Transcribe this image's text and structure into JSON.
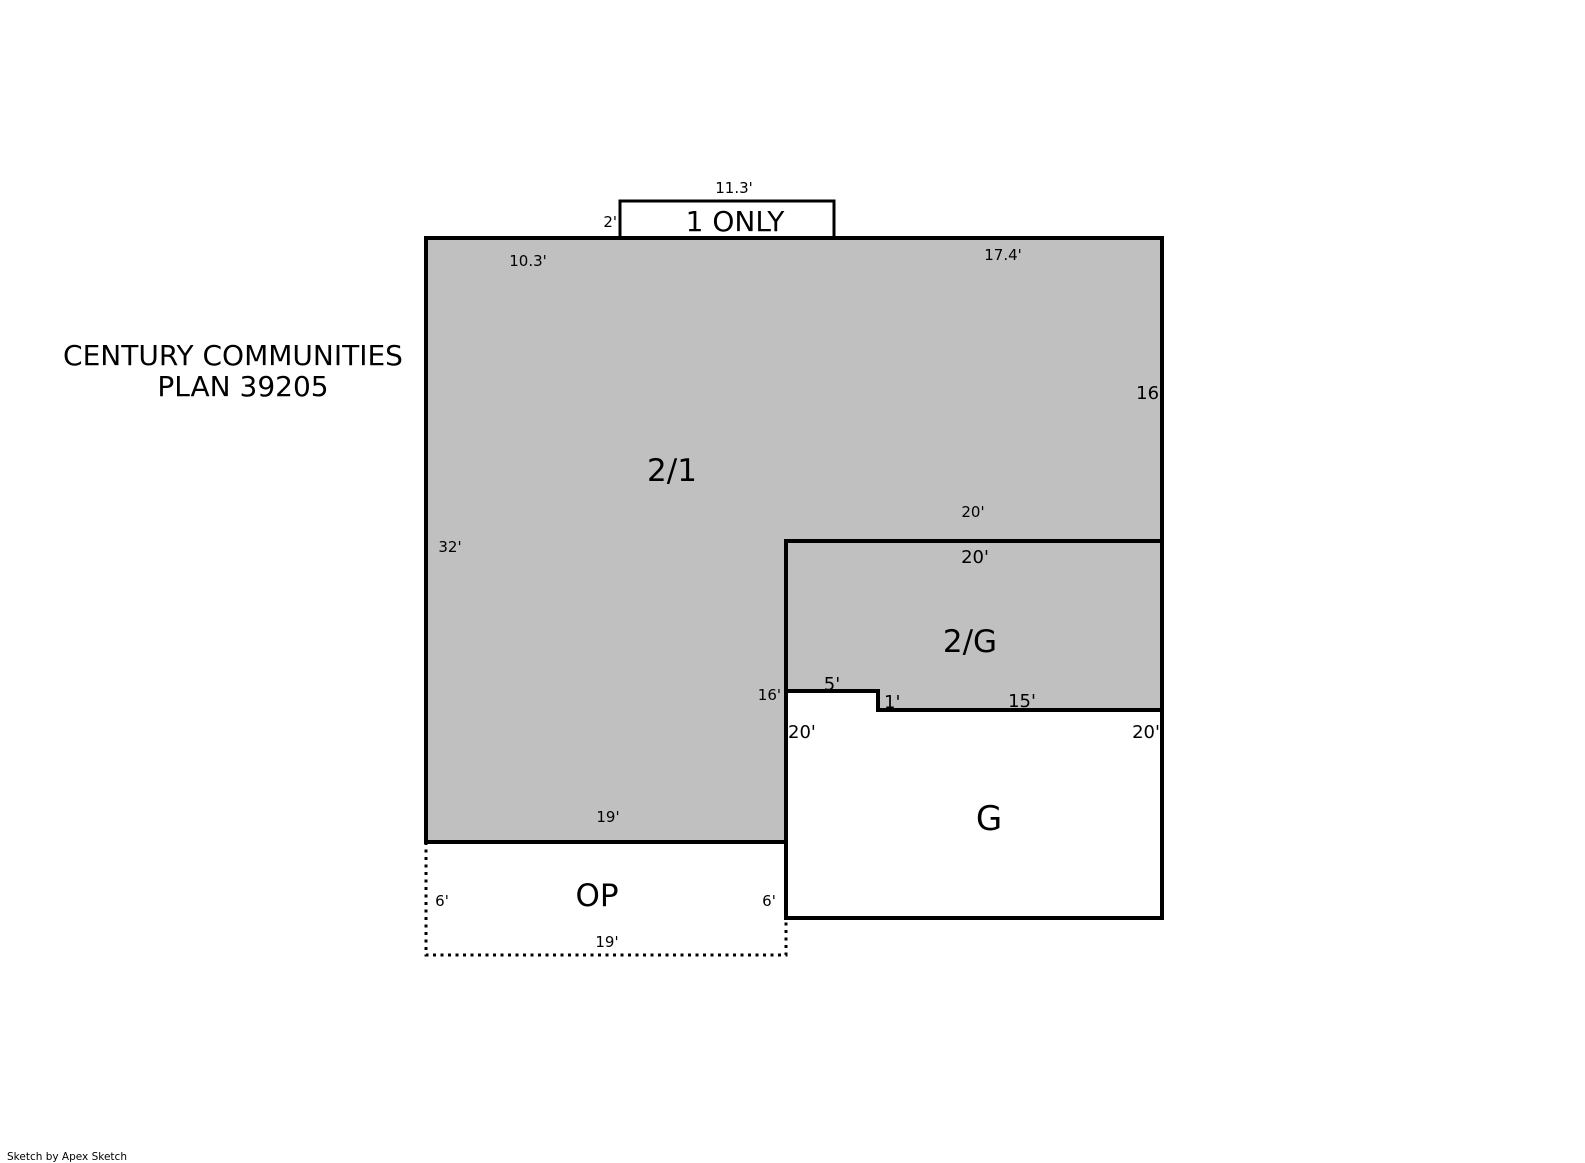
{
  "title": {
    "line1": "CENTURY COMMUNITIES",
    "line2": "PLAN 39205"
  },
  "footer": {
    "credit": "Sketch by Apex Sketch"
  },
  "colors": {
    "shaded_area_fill": "#c0c0c0",
    "open_area_fill": "#ffffff",
    "outline": "#000000",
    "background": "#ffffff"
  },
  "areas": {
    "one_only": {
      "label": "1 ONLY"
    },
    "two_one": {
      "label": "2/1"
    },
    "two_g": {
      "label": "2/G"
    },
    "g": {
      "label": "G"
    },
    "op": {
      "label": "OP"
    }
  },
  "dims": {
    "one_only_top": "11.3'",
    "one_only_left": "2'",
    "main_top_left": "10.3'",
    "main_top_right": "17.4'",
    "main_right": "16'",
    "main_left": "32'",
    "split_above": "20'",
    "split_below": "20'",
    "step_left": "16'",
    "step_top": "5'",
    "step_side": "1'",
    "two_g_bottom": "15'",
    "g_left": "20'",
    "g_right": "20'",
    "main_bottom": "19'",
    "op_left": "6'",
    "op_right": "6'",
    "op_bottom": "19'"
  }
}
